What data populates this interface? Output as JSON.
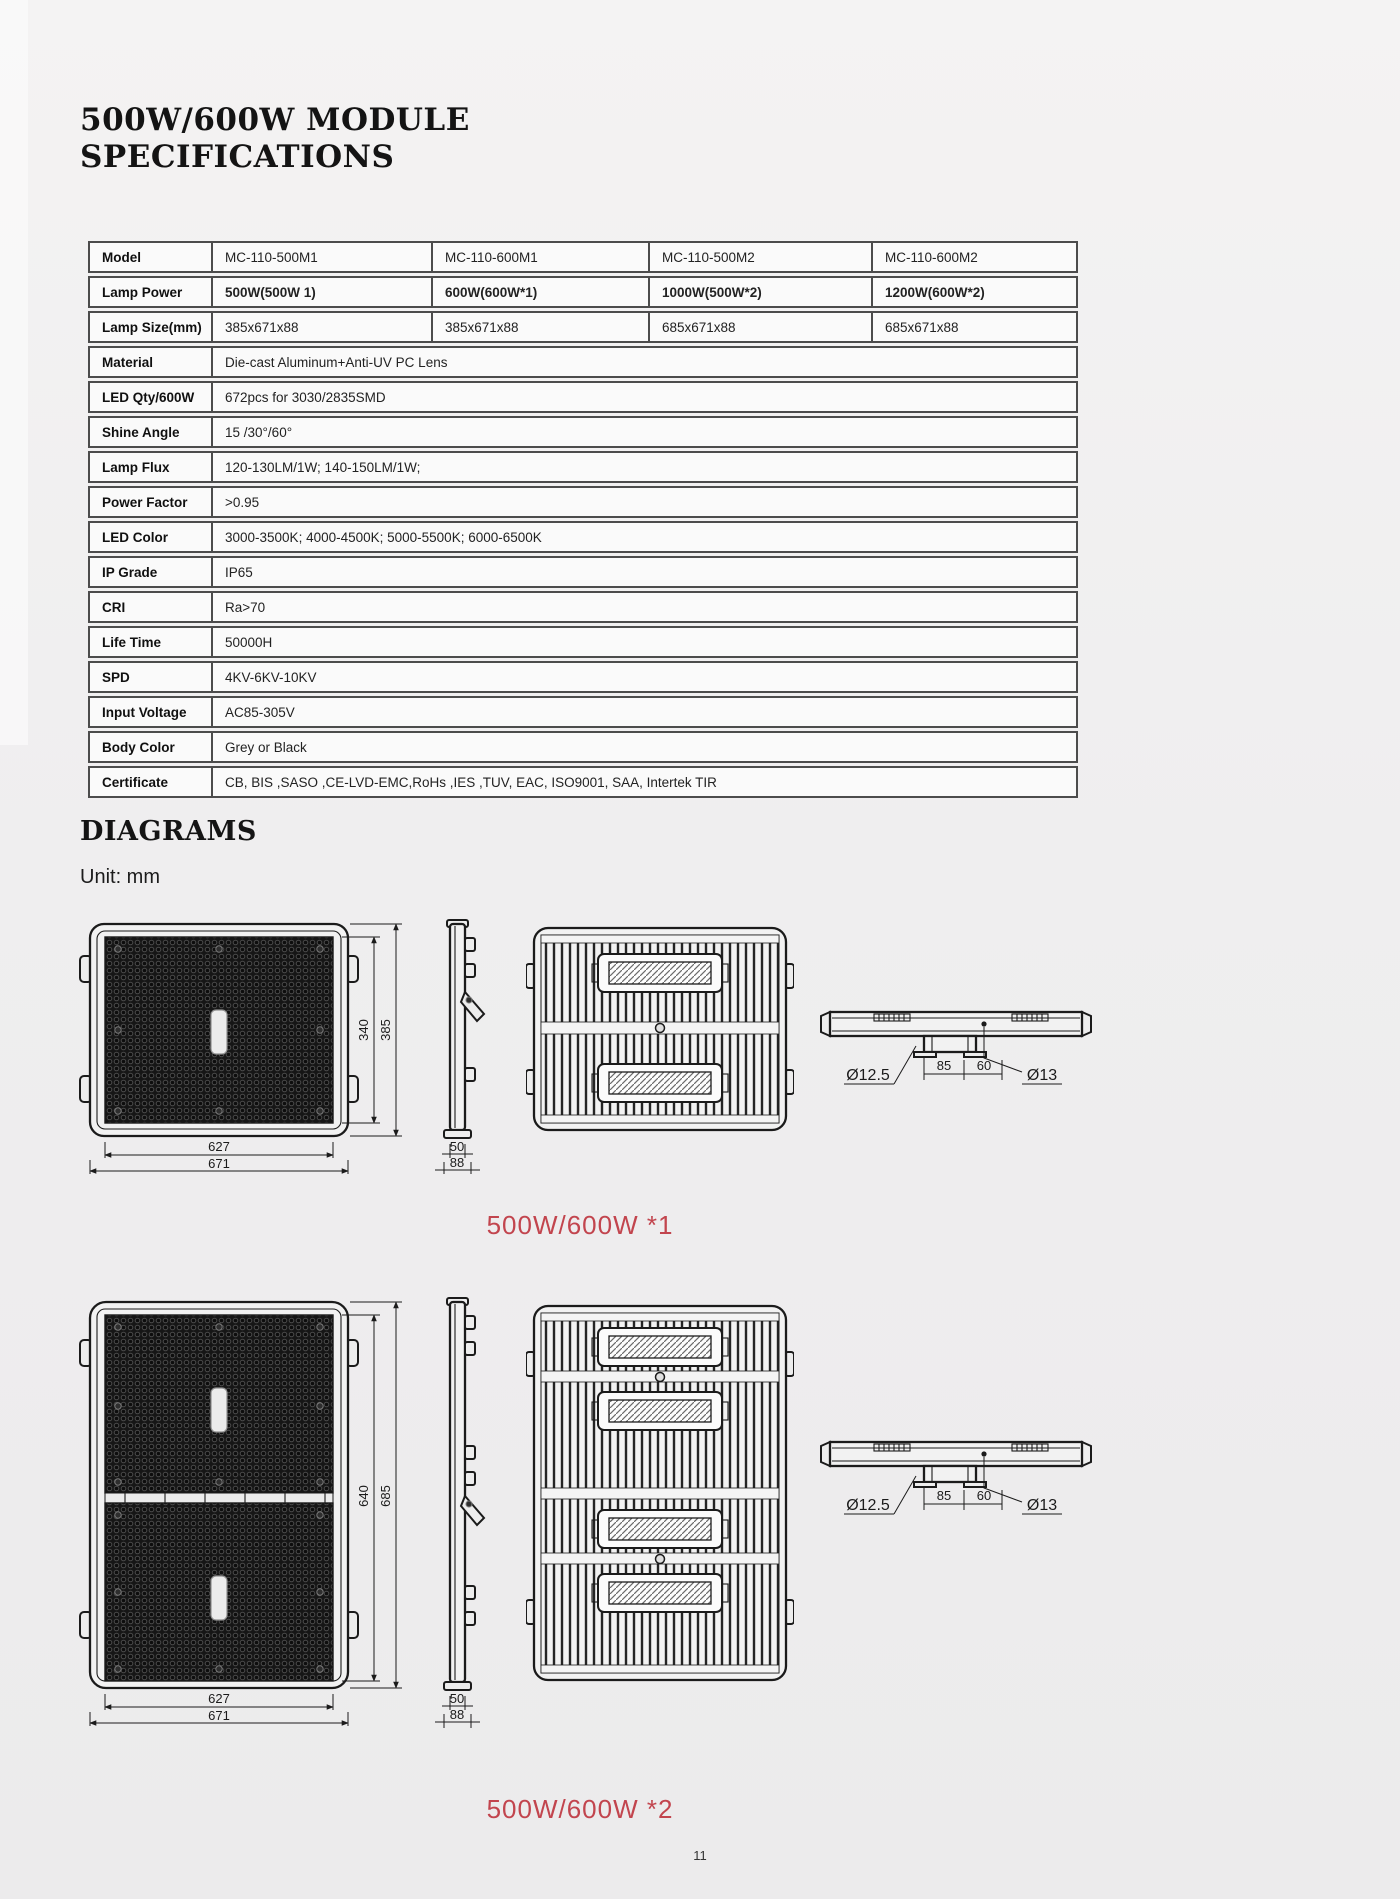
{
  "page": {
    "number": "11"
  },
  "header": {
    "title_line1": "500W/600W MODULE",
    "title_line2": "SPECIFICATIONS"
  },
  "table": {
    "rows": [
      {
        "label": "Model",
        "values": [
          "MC-110-500M1",
          "MC-110-600M1",
          "MC-110-500M2",
          "MC-110-600M2"
        ]
      },
      {
        "label": "Lamp Power",
        "values": [
          "500W(500W 1)",
          "600W(600W*1)",
          "1000W(500W*2)",
          "1200W(600W*2)"
        ]
      },
      {
        "label": "Lamp Size(mm)",
        "values": [
          "385x671x88",
          "385x671x88",
          "685x671x88",
          "685x671x88"
        ]
      },
      {
        "label": "Material",
        "span": "Die-cast Aluminum+Anti-UV PC Lens"
      },
      {
        "label": "LED Qty/600W",
        "span": "672pcs for 3030/2835SMD"
      },
      {
        "label": "Shine Angle",
        "span": "15 /30°/60°"
      },
      {
        "label": "Lamp Flux",
        "span": "120-130LM/1W; 140-150LM/1W;"
      },
      {
        "label": "Power Factor",
        "span": ">0.95"
      },
      {
        "label": "LED Color",
        "span": "3000-3500K; 4000-4500K; 5000-5500K; 6000-6500K"
      },
      {
        "label": "IP Grade",
        "span": "IP65"
      },
      {
        "label": "CRI",
        "span": "Ra>70"
      },
      {
        "label": "Life Time",
        "span": "50000H"
      },
      {
        "label": "SPD",
        "span": "4KV-6KV-10KV"
      },
      {
        "label": "Input Voltage",
        "span": "AC85-305V"
      },
      {
        "label": "Body Color",
        "span": "Grey or Black"
      },
      {
        "label": "Certificate",
        "span": "CB, BIS ,SASO ,CE-LVD-EMC,RoHs ,IES ,TUV, EAC, ISO9001, SAA, Intertek TIR"
      }
    ]
  },
  "diagrams": {
    "heading": "DIAGRAMS",
    "unit_label": "Unit: mm",
    "accent_color": "#c2454e",
    "group1": {
      "caption": "500W/600W *1",
      "front": {
        "height_inner": "340",
        "height_outer": "385",
        "width_inner": "627",
        "width_outer": "671"
      },
      "side": {
        "thickness": "50",
        "depth": "88"
      },
      "top": {
        "hole_left": "Ø12.5",
        "span_a": "85",
        "span_b": "60",
        "hole_right": "Ø13"
      }
    },
    "group2": {
      "caption": "500W/600W *2",
      "front": {
        "height_inner": "640",
        "height_outer": "685",
        "width_inner": "627",
        "width_outer": "671"
      },
      "side": {
        "thickness": "50",
        "depth": "88"
      },
      "top": {
        "hole_left": "Ø12.5",
        "span_a": "85",
        "span_b": "60",
        "hole_right": "Ø13"
      }
    }
  }
}
